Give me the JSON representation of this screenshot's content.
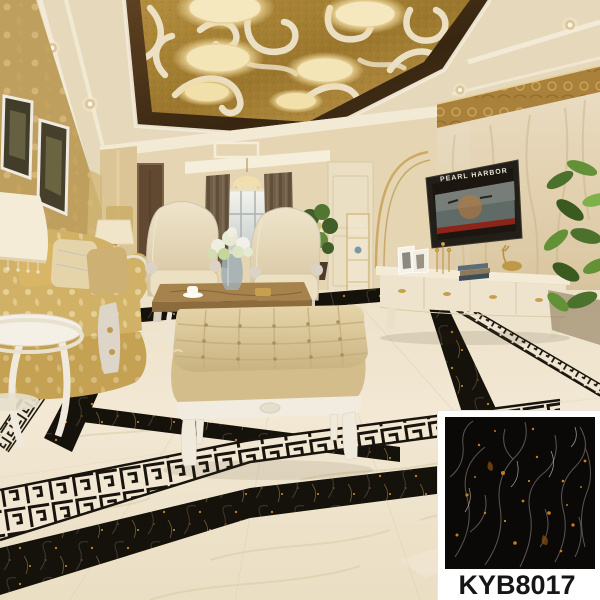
{
  "product": {
    "code": "KYB8017"
  },
  "tv": {
    "movie_title": "PEARL HARBOR"
  },
  "palette": {
    "ceiling_gold_panel": "#a9853b",
    "ceiling_dark_frame": "#44301a",
    "wallpaper_gold": "#bfa05e",
    "marble_wall_beige": "#e3d5b8",
    "floor_marble_cream": "#f0e7d3",
    "inlay_black_marble": "#0f0d0a",
    "swatch_tile_black": "#0b0908",
    "swatch_gold_fleck": "#d08a20",
    "label_color": "#161616"
  }
}
